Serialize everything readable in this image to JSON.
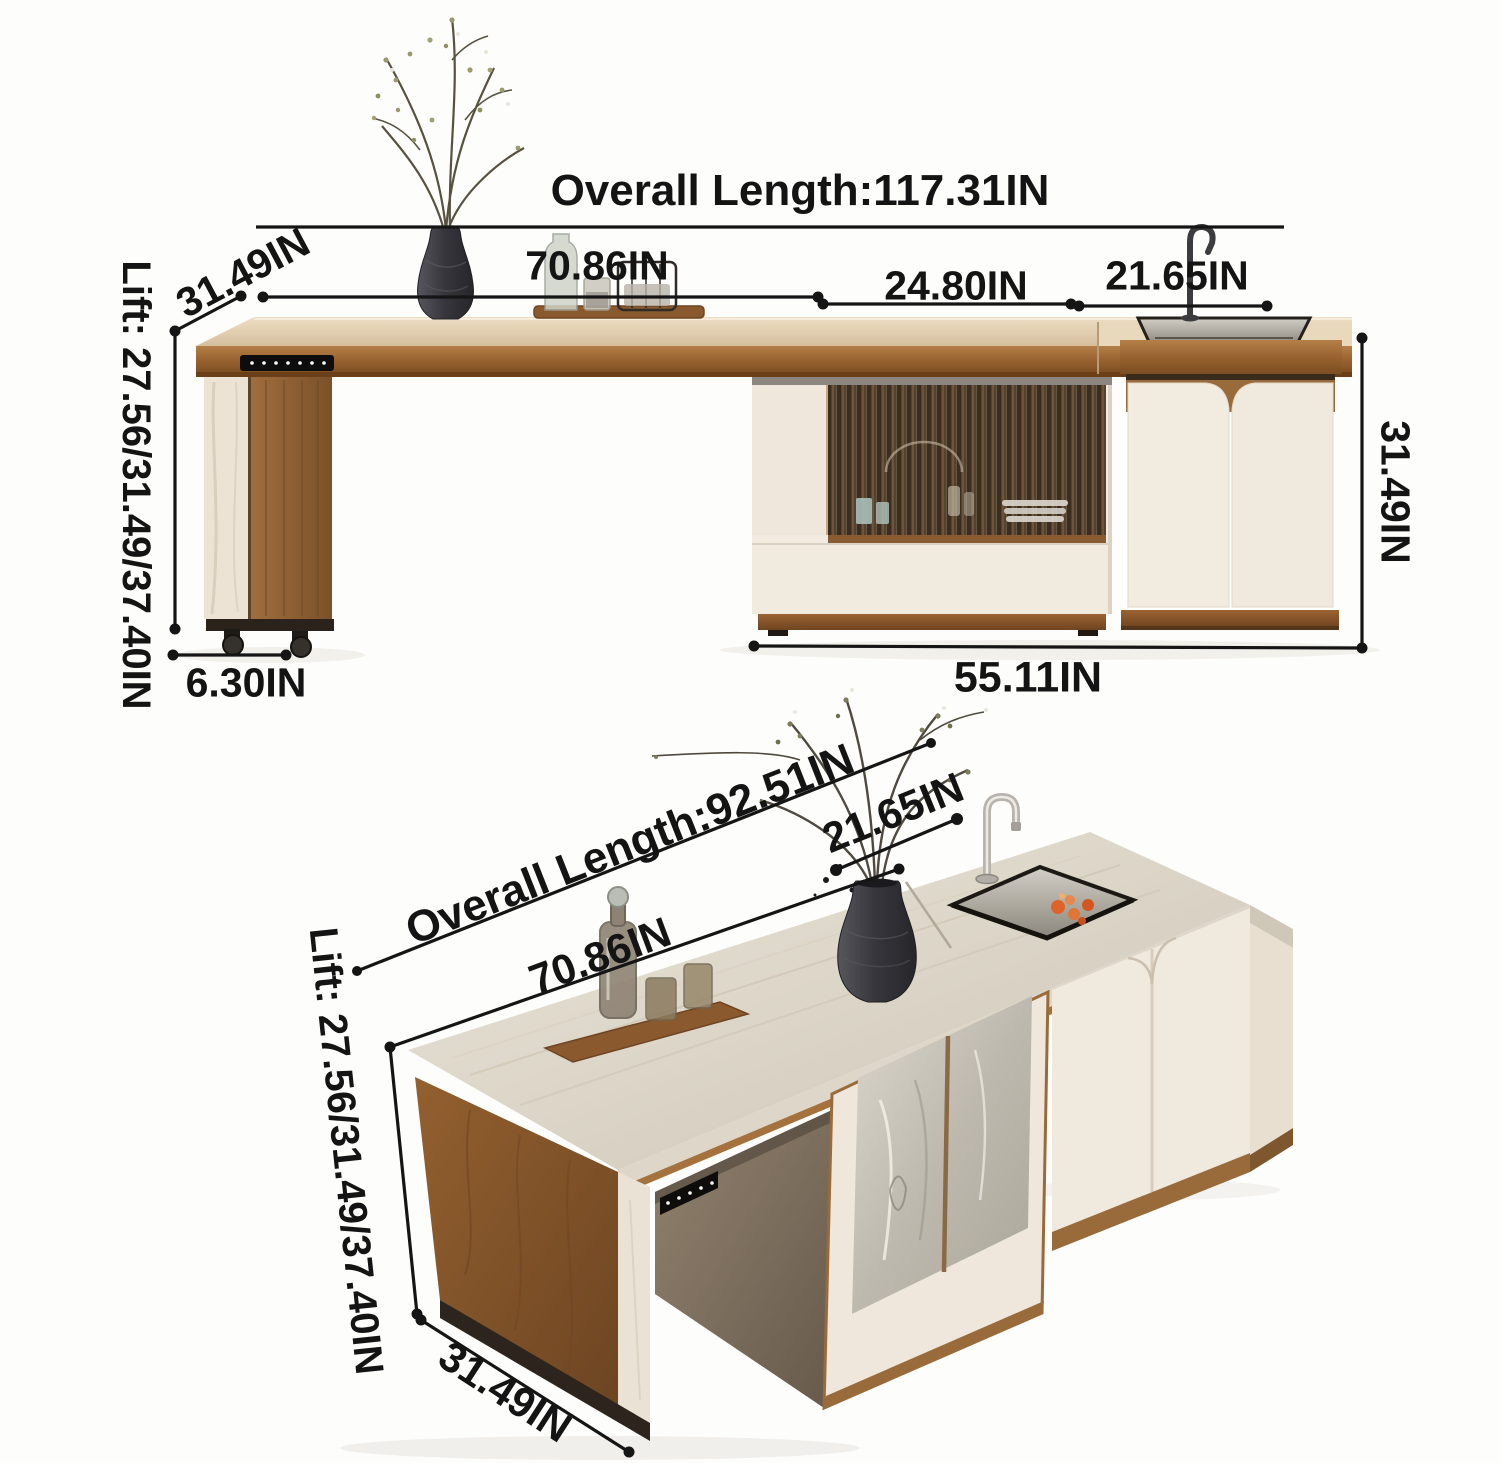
{
  "figure_top": {
    "overall_length": "Overall Length:117.31IN",
    "top_depth": "31.49IN",
    "lift_range": "Lift: 27.56/31.49/37.40IN",
    "table_length": "70.86IN",
    "cabinet_length": "24.80IN",
    "sink_length": "21.65IN",
    "leg_depth": "6.30IN",
    "cabinet_base_length": "55.11IN",
    "cabinet_height": "31.49IN"
  },
  "figure_bottom": {
    "overall_length": "Overall Length:92.51IN",
    "sink_length": "21.65IN",
    "table_length": "70.86IN",
    "lift_range": "Lift: 27.56/31.49/37.40IN",
    "table_depth": "31.49IN"
  },
  "colors": {
    "text": "#141414",
    "wood": "#9a6b3a",
    "cream_panel": "#f1eade",
    "marble_top": "#e7e2d8",
    "fluted_glass": "#3b2e21",
    "carrot_accent": "#dd6327"
  }
}
